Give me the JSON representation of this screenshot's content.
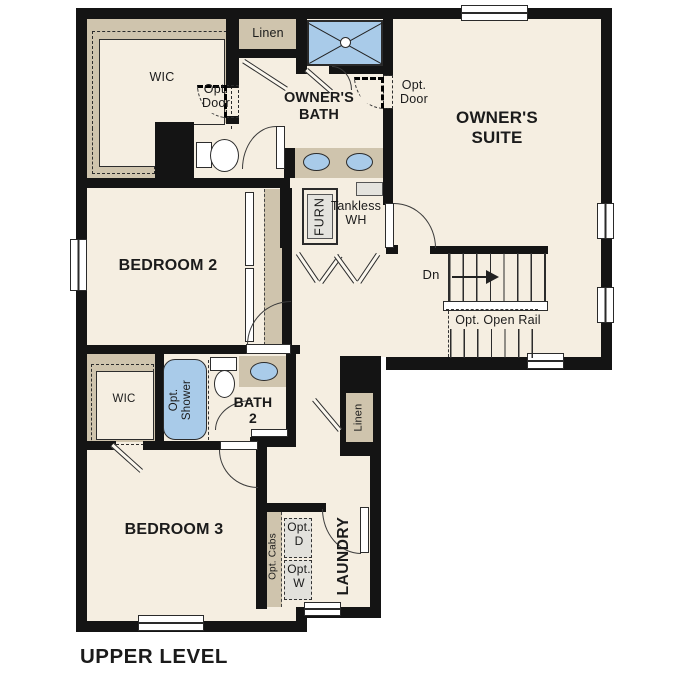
{
  "title": "UPPER LEVEL",
  "colors": {
    "wall": "#141414",
    "floor": "#f5eee1",
    "closet_tan": "#cfc4ad",
    "fixture_blue": "#a9cbe9",
    "appliance_gray": "#e4e3de"
  },
  "rooms": {
    "wic_upper": "WIC",
    "owners_bath": "OWNER'S\nBATH",
    "owners_suite": "OWNER'S\nSUITE",
    "bedroom_2": "BEDROOM 2",
    "bath_2": "BATH\n2",
    "wic_lower": "WIC",
    "bedroom_3": "BEDROOM 3",
    "laundry": "LAUNDRY"
  },
  "closets": {
    "linen_top": "Linen",
    "linen_hall": "Linen"
  },
  "stairs": {
    "down": "Dn",
    "opt_open_rail": "Opt. Open Rail"
  },
  "equipment": {
    "furnace": "FURN",
    "tankless": "Tankless\nWH"
  },
  "options": {
    "opt_door_wic": "Opt.\nDoor",
    "opt_door_suite": "Opt.\nDoor",
    "opt_shower": "Opt.\nShower",
    "opt_cabs": "Opt. Cabs",
    "opt_dryer": "Opt.\nD",
    "opt_washer": "Opt.\nW"
  }
}
